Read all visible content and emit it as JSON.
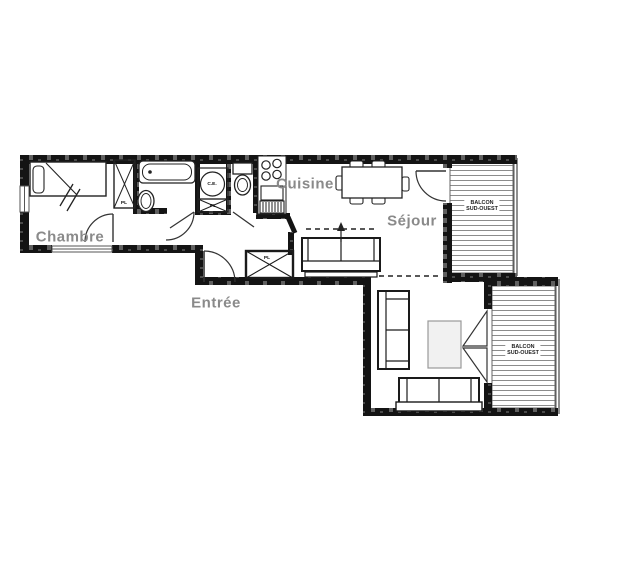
{
  "labels": {
    "chambre": "Chambre",
    "cuisine": "Cuisine",
    "sejour": "Séjour",
    "entree": "Entrée",
    "balcony1": {
      "line1": "BALCON",
      "line2": "SUD-OUEST"
    },
    "balcony2": {
      "line1": "BALCON",
      "line2": "SUD-OUEST"
    },
    "water_heater": "C.E.",
    "closet": "PL"
  },
  "colors": {
    "background": "#ffffff",
    "wall": "#141414",
    "room_label_gray": "#8a8a8a",
    "line": "#2b2b2b",
    "balcony_hatch_line": "#8c8c8c"
  }
}
